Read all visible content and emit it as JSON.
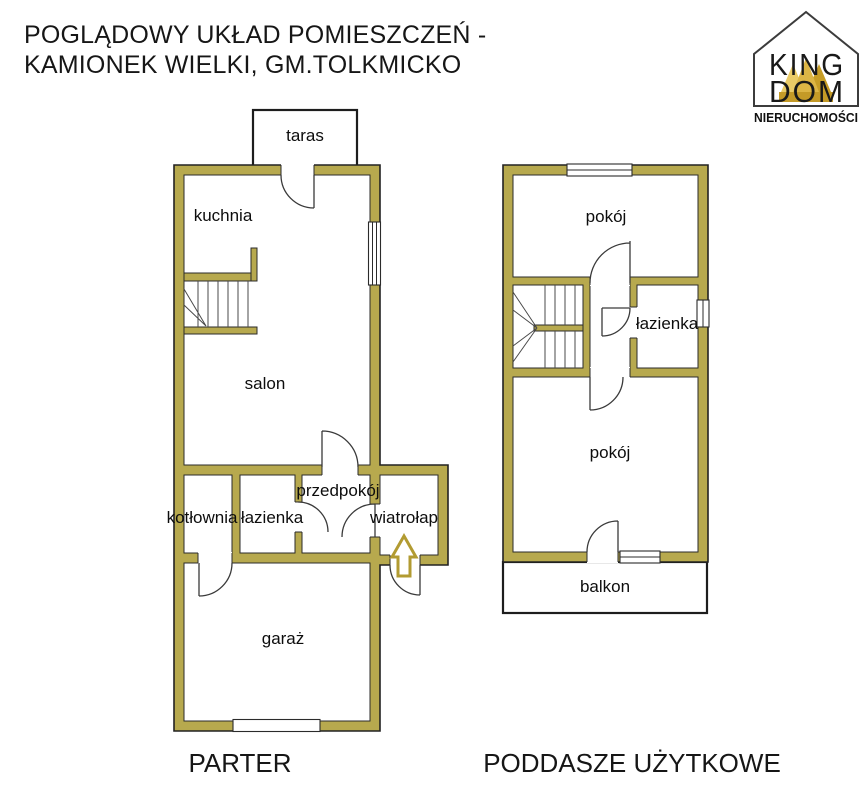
{
  "title": {
    "line1": "POGLĄDOWY UKŁAD POMIESZCZEŃ -",
    "line2": "KAMIONEK WIELKI, GM.TOLKMICKO"
  },
  "logo": {
    "word1": "KING",
    "word2": "DOM",
    "subtitle": "NIERUCHOMOŚCI"
  },
  "floors": {
    "parter": {
      "name": "PARTER",
      "rooms": {
        "taras": "taras",
        "kuchnia": "kuchnia",
        "salon": "salon",
        "przedpokoj": "przedpokój",
        "kotlownia": "kotłownia",
        "lazienka": "łazienka",
        "wiatrolap": "wiatrołap",
        "garaz": "garaż"
      }
    },
    "poddasze": {
      "name": "PODDASZE UŻYTKOWE",
      "rooms": {
        "pokoj_gorny": "pokój",
        "lazienka": "łazienka",
        "pokoj_dolny": "pokój",
        "balkon": "balkon"
      }
    }
  },
  "colors": {
    "wall_fill": "#b7a94e",
    "wall_outline": "#2b2b2b",
    "entrance_arrow": "#b29b32",
    "crown_gold": "#caa52e"
  }
}
